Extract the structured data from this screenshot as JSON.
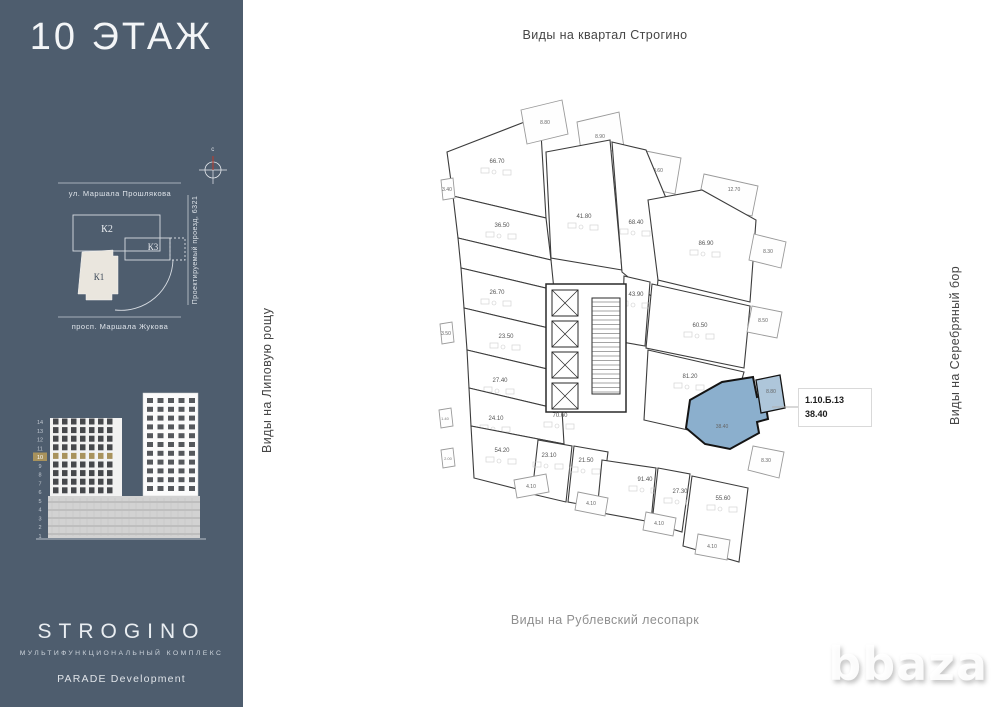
{
  "sidebar": {
    "floor_title": "10 ЭТАЖ",
    "map": {
      "street_top": "ул. Маршала Прошлякова",
      "street_bottom": "просп. Маршала Жукова",
      "street_right": "Проектируемый проезд, 6321",
      "compass_label": "с",
      "k1": "К1",
      "k2": "К2",
      "k3": "К3"
    },
    "elevation": {
      "floors": [
        "14",
        "13",
        "12",
        "11",
        "10",
        "9",
        "8",
        "7",
        "6",
        "5",
        "4",
        "3",
        "2",
        "1"
      ],
      "highlighted_floor": "10",
      "highlight_color": "#a8925c"
    },
    "brand": {
      "name": "STROGINO",
      "subtitle": "МУЛЬТИФУНКЦИОНАЛЬНЫЙ КОМПЛЕКС",
      "developer": "PARADE Development"
    }
  },
  "views": {
    "top": "Виды на квартал Строгино",
    "bottom": "Виды на Рублевский лесопарк",
    "left": "Виды на Липовую рощу",
    "right": "Виды на Серебряный бор"
  },
  "callout": {
    "unit_id": "1.10.Б.13",
    "area": "38.40"
  },
  "watermark": "bbaza",
  "plan": {
    "highlight_fill": "#8bafcd",
    "wall_color": "#3c3c3c",
    "core": {
      "outline": "546,284 626,284 626,412 546,412",
      "lifts": [
        [
          552,
          290
        ],
        [
          552,
          321
        ],
        [
          552,
          352
        ],
        [
          552,
          383
        ]
      ],
      "lift_w": 26,
      "lift_h": 26,
      "stair": [
        592,
        298,
        28,
        96
      ]
    },
    "units": [
      {
        "area": "66.70",
        "points": "447,152 540,116 546,218 453,196",
        "lx": 497,
        "ly": 163
      },
      {
        "area": "36.50",
        "points": "453,196 546,218 551,260 458,238",
        "lx": 502,
        "ly": 227
      },
      {
        "area": "",
        "points": "458,238 551,260 554,290 461,268",
        "lx": 0,
        "ly": 0
      },
      {
        "area": "26.70",
        "points": "461,268 554,290 557,330 464,308",
        "lx": 497,
        "ly": 294
      },
      {
        "area": "23.50",
        "points": "464,308 557,330 560,372 467,350",
        "lx": 506,
        "ly": 338
      },
      {
        "area": "27.40",
        "points": "467,350 560,372 562,410 469,388",
        "lx": 500,
        "ly": 382
      },
      {
        "area": "24.10",
        "points": "469,388 562,410 564,444 471,426",
        "lx": 496,
        "ly": 420
      },
      {
        "area": "54.20",
        "points": "471,426 564,444 560,500 474,478",
        "lx": 502,
        "ly": 452
      },
      {
        "area": "8.80",
        "type": "balcony",
        "points": "521,110 562,100 568,134 527,144",
        "lx": 545,
        "ly": 124
      },
      {
        "area": "8.90",
        "type": "balcony",
        "points": "577,122 619,112 624,148 582,158",
        "lx": 600,
        "ly": 138
      },
      {
        "area": "8.60",
        "type": "balcony",
        "points": "641,150 681,158 675,194 635,186",
        "lx": 658,
        "ly": 172
      },
      {
        "area": "12.70",
        "type": "balcony",
        "points": "704,174 758,186 752,216 698,204",
        "lx": 734,
        "ly": 191
      },
      {
        "area": "41.80",
        "points": "546,152 610,140 622,270 551,258",
        "lx": 584,
        "ly": 218
      },
      {
        "area": "68.40",
        "points": "612,142 646,150 666,198 656,300 622,272",
        "lx": 636,
        "ly": 224
      },
      {
        "area": "86.90",
        "points": "648,200 702,190 756,220 750,302 658,280",
        "lx": 706,
        "ly": 245
      },
      {
        "area": "8.30",
        "type": "balcony",
        "points": "754,234 786,242 781,268 749,260",
        "lx": 768,
        "ly": 253
      },
      {
        "area": "43.90",
        "points": "624,276 650,282 645,346 622,342",
        "lx": 636,
        "ly": 296
      },
      {
        "area": "60.50",
        "points": "652,284 750,306 744,368 646,348",
        "lx": 700,
        "ly": 327
      },
      {
        "area": "8.50",
        "type": "balcony",
        "points": "752,306 782,312 777,338 747,332",
        "lx": 763,
        "ly": 322
      },
      {
        "area": "81.20",
        "points": "648,350 744,372 736,400 696,398 688,430 644,420",
        "lx": 690,
        "ly": 378
      },
      {
        "area": "70.60",
        "lx": 560,
        "ly": 417
      },
      {
        "area": "38.40",
        "type": "highlight",
        "points": "690,400 722,382 753,377 757,397 764,395 768,419 757,422 759,433 730,449 705,444 686,428",
        "lx": 722,
        "ly": 428
      },
      {
        "area": "8.80",
        "type": "highlight-balcony",
        "points": "756,380 780,375 785,408 761,413",
        "lx": 771,
        "ly": 393
      },
      {
        "area": "8.30",
        "type": "balcony",
        "points": "753,446 784,452 779,478 748,470",
        "lx": 766,
        "ly": 462
      },
      {
        "area": "23.10",
        "points": "538,440 572,446 566,502 532,494",
        "lx": 549,
        "ly": 457
      },
      {
        "area": "21.50",
        "points": "574,446 608,452 601,508 568,502",
        "lx": 586,
        "ly": 462
      },
      {
        "area": "91.40",
        "points": "602,460 656,468 651,522 597,512",
        "lx": 645,
        "ly": 481
      },
      {
        "area": "27.30",
        "points": "658,468 690,474 682,532 652,523",
        "lx": 680,
        "ly": 493
      },
      {
        "area": "55.60",
        "points": "692,476 748,488 739,562 683,546",
        "lx": 723,
        "ly": 500
      },
      {
        "area": "4.10",
        "type": "balcony",
        "points": "514,480 546,474 549,492 517,498",
        "lx": 531,
        "ly": 488
      },
      {
        "area": "4.10",
        "type": "balcony",
        "points": "578,492 608,498 605,516 575,510",
        "lx": 591,
        "ly": 505
      },
      {
        "area": "4.10",
        "type": "balcony",
        "points": "646,512 676,518 673,536 643,530",
        "lx": 659,
        "ly": 525
      },
      {
        "area": "4.10",
        "type": "balcony",
        "points": "698,534 730,540 727,560 695,554",
        "lx": 712,
        "ly": 548
      },
      {
        "area": "3.40",
        "type": "balcony",
        "points": "441,180 453,178 455,198 443,200",
        "lx": 447,
        "ly": 191
      },
      {
        "area": "3.50",
        "type": "balcony",
        "points": "440,324 452,322 454,342 442,344",
        "lx": 446,
        "ly": 335
      },
      {
        "area": "1.40",
        "type": "balcony",
        "points": "439,410 451,408 453,426 441,428",
        "lx": 445,
        "ly": 420
      },
      {
        "area": "2.00",
        "type": "balcony",
        "points": "441,450 453,448 455,466 443,468",
        "lx": 448,
        "ly": 460
      }
    ]
  }
}
